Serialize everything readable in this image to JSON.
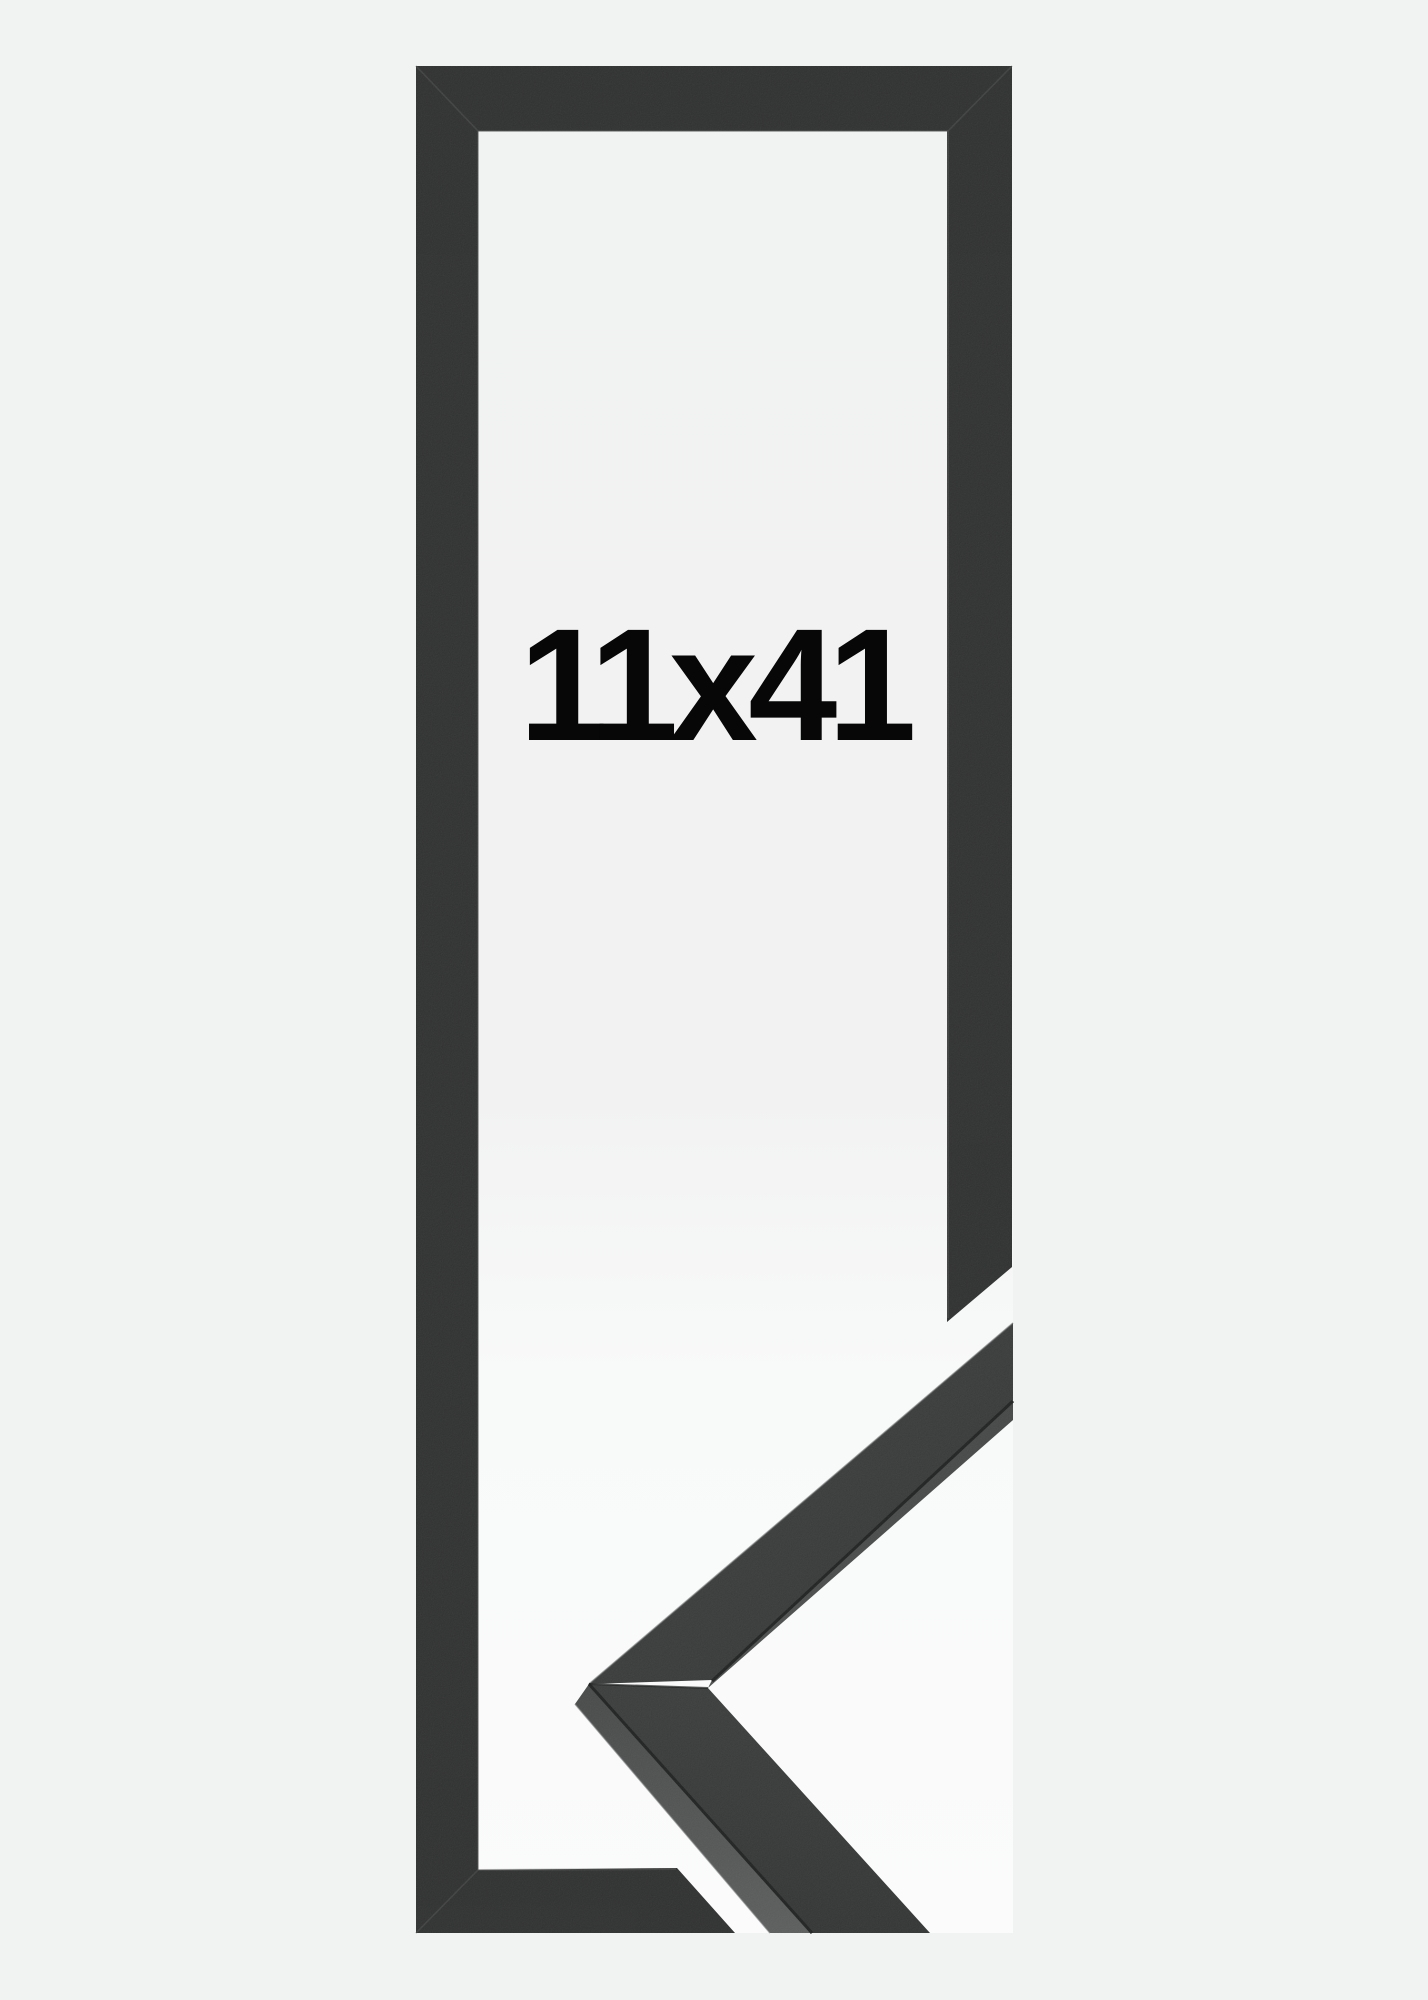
{
  "product": {
    "size_label": "11x41"
  },
  "colors": {
    "background": "#f1f2f2",
    "photo_highlight": "#fbfbfb",
    "frame": "#2b2c2c",
    "sample_top_face": "#343636",
    "sample_side_face": "#4c4e4f",
    "label": "#070707"
  }
}
